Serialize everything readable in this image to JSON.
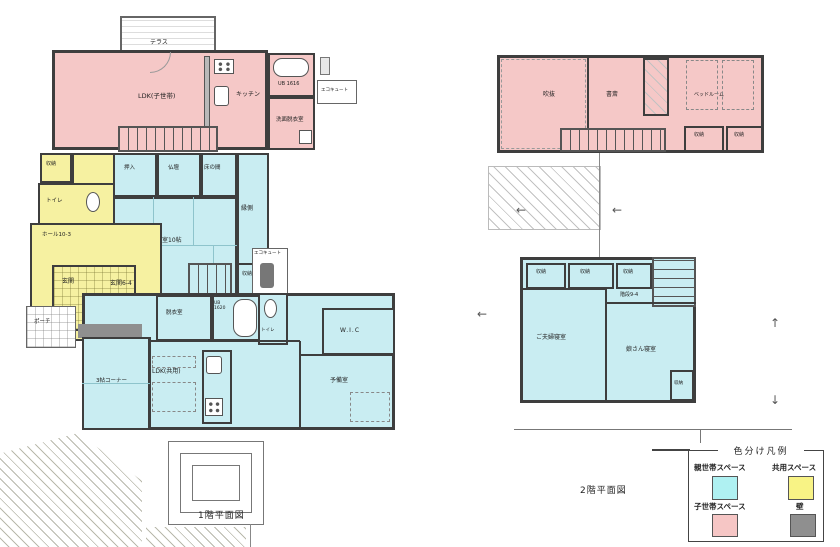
{
  "palette": {
    "parent_space": "#c9edf2",
    "shared_space": "#f6f1a1",
    "child_space": "#f5c8c7",
    "wall": "#8f8f8f",
    "line": "#3e3e3e"
  },
  "f1": {
    "caption": "1階平面図",
    "terrace": "テラス",
    "ldk": "LDK(子世帯)",
    "kitchen": "キッチン",
    "ub1": "UB 1616",
    "senmen": "洗面脱衣室",
    "eco1": "エコキュート",
    "shuno_a": "収納",
    "toilet_a": "トイレ",
    "hall": "ホール10-3",
    "oshiire": "押入",
    "butsudan": "仏壇",
    "tokonoma": "床の間",
    "washitsu": "和室10帖",
    "engawa": "縁側",
    "shuno_b": "収納",
    "eco2": "エコキュート",
    "genkan": "玄関",
    "genkan_hall": "玄関6-4",
    "porch": "ポーチ",
    "datsui": "脱衣室",
    "ub2": "UB 1620",
    "toilet_b": "トイレ",
    "wic": "W.I.C",
    "yobi": "予備室",
    "ldk2": "LDK(共用)",
    "corner": "3帖コーナー"
  },
  "f2": {
    "caption": "2階平面図",
    "fukinuke": "吹抜",
    "shosai": "書斎",
    "bedroom": "ベッドルーム",
    "shuno_d": "収納",
    "shuno_e": "収納",
    "shuno_a": "収納",
    "shuno_b": "収納",
    "shuno_c": "収納",
    "kaidan": "階段9-4",
    "couple": "ご夫婦寝室",
    "daughter": "娘さん寝室",
    "shuno_f": "収納"
  },
  "legend": {
    "title": "色分け凡例",
    "items": [
      {
        "label": "親世帯スペース",
        "color": "#aff1f2"
      },
      {
        "label": "共用スペース",
        "color": "#f8f385"
      },
      {
        "label": "子世帯スペース",
        "color": "#f6c6c5"
      },
      {
        "label": "壁",
        "color": "#8f8f8f"
      }
    ]
  },
  "arrows": {
    "left": "←",
    "up": "↑",
    "down": "↓"
  }
}
